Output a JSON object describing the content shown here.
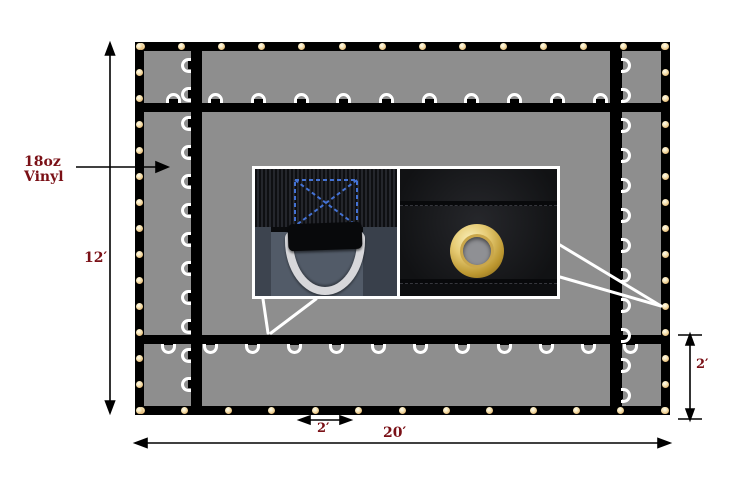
{
  "canvas": {
    "width": 736,
    "height": 487,
    "background": "#ffffff"
  },
  "annotations": {
    "material": {
      "line1": "18oz",
      "line2": "Vinyl"
    },
    "height_dim": "12′",
    "width_dim": "20′",
    "grommet_spacing_dim": "2′",
    "edge_offset_dim": "2′",
    "text_color": "#7a1016"
  },
  "tarp": {
    "fabric_color": "#8e8e8e",
    "webbing_color": "#000000",
    "dring_color": "#ffffff",
    "grommet_color": "#f5e3b4",
    "grommet_rim_color": "#c98f3f"
  },
  "hardware": {
    "grommets": {
      "top": 14,
      "bottom": 13,
      "left": 15,
      "right": 15
    },
    "d_rings": {
      "top": 11,
      "bottom": 12,
      "left": 12,
      "right": 12
    }
  },
  "inset": {
    "left_photo": "d-ring closeup with box-x stitched webbing",
    "right_photo": "brass grommet closeup on black hem",
    "stitch_color": "#4472d4"
  }
}
